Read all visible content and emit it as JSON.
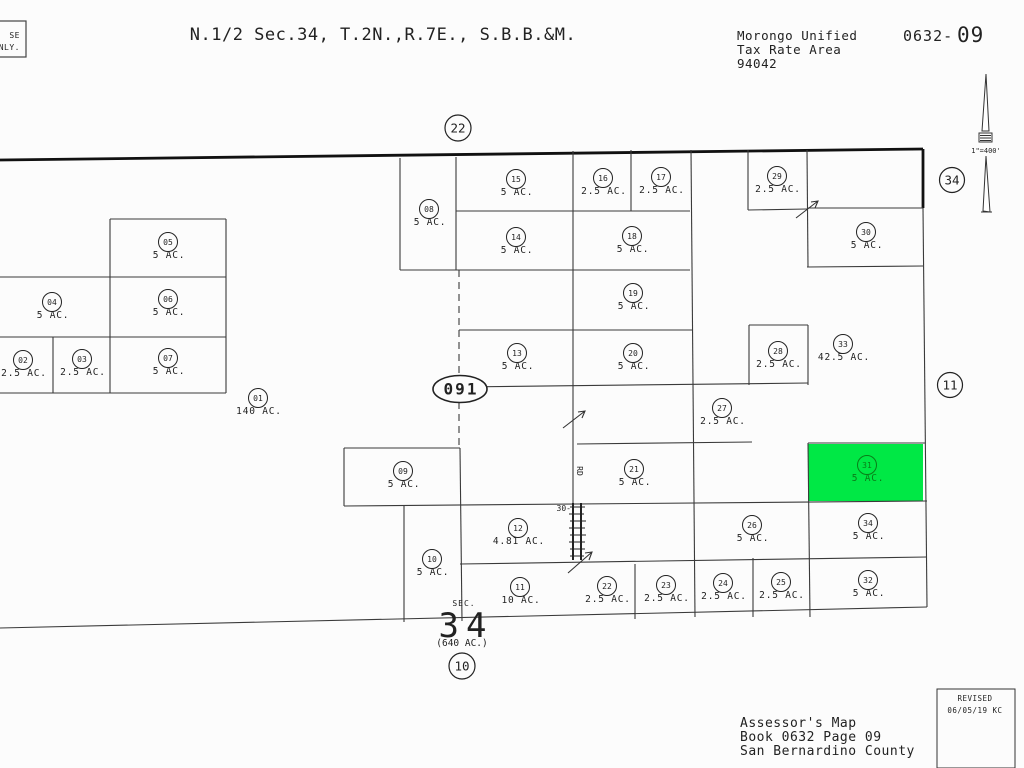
{
  "header": {
    "stamp": {
      "line1": "SE",
      "line2": "NLY."
    },
    "title": "N.1/2 Sec.34, T.2N.,R.7E., S.B.B.&M.",
    "tax_rate_area": {
      "line1": "Morongo Unified",
      "line2": "Tax Rate Area",
      "line3": "94042"
    },
    "book_page": {
      "prefix": "0632-",
      "page": "09"
    }
  },
  "north_arrow": {
    "scale_label": "1\"=400'"
  },
  "map": {
    "adjacent_page_refs": {
      "top": "22",
      "right_upper": "34",
      "right_lower": "11",
      "bottom": "10"
    },
    "book_marker": "091",
    "section": {
      "label": "SEC.",
      "number": "34",
      "acreage": "(640 AC.)"
    },
    "road": {
      "width_label": "30-",
      "name": "RD"
    },
    "highlight_color": "#00e845",
    "highlight_label_color": "#0a7d18",
    "parcels": [
      {
        "n": "01",
        "ac": "140 AC.",
        "x": 258,
        "y": 398
      },
      {
        "n": "02",
        "ac": "2.5 AC.",
        "x": 23,
        "y": 360
      },
      {
        "n": "03",
        "ac": "2.5 AC.",
        "x": 82,
        "y": 359
      },
      {
        "n": "04",
        "ac": "5 AC.",
        "x": 52,
        "y": 302
      },
      {
        "n": "05",
        "ac": "5 AC.",
        "x": 168,
        "y": 242
      },
      {
        "n": "06",
        "ac": "5 AC.",
        "x": 168,
        "y": 299
      },
      {
        "n": "07",
        "ac": "5 AC.",
        "x": 168,
        "y": 358
      },
      {
        "n": "08",
        "ac": "5 AC.",
        "x": 429,
        "y": 209
      },
      {
        "n": "09",
        "ac": "5 AC.",
        "x": 403,
        "y": 471
      },
      {
        "n": "10",
        "ac": "5 AC.",
        "x": 432,
        "y": 559
      },
      {
        "n": "11",
        "ac": "10 AC.",
        "x": 520,
        "y": 587
      },
      {
        "n": "12",
        "ac": "4.81 AC.",
        "x": 518,
        "y": 528
      },
      {
        "n": "13",
        "ac": "5 AC.",
        "x": 517,
        "y": 353
      },
      {
        "n": "14",
        "ac": "5 AC.",
        "x": 516,
        "y": 237
      },
      {
        "n": "15",
        "ac": "5 AC.",
        "x": 516,
        "y": 179
      },
      {
        "n": "16",
        "ac": "2.5 AC.",
        "x": 603,
        "y": 178
      },
      {
        "n": "17",
        "ac": "2.5 AC.",
        "x": 661,
        "y": 177
      },
      {
        "n": "18",
        "ac": "5 AC.",
        "x": 632,
        "y": 236
      },
      {
        "n": "19",
        "ac": "5 AC.",
        "x": 633,
        "y": 293
      },
      {
        "n": "20",
        "ac": "5 AC.",
        "x": 633,
        "y": 353
      },
      {
        "n": "21",
        "ac": "5 AC.",
        "x": 634,
        "y": 469
      },
      {
        "n": "22",
        "ac": "2.5 AC.",
        "x": 607,
        "y": 586
      },
      {
        "n": "23",
        "ac": "2.5 AC.",
        "x": 666,
        "y": 585
      },
      {
        "n": "24",
        "ac": "2.5 AC.",
        "x": 723,
        "y": 583
      },
      {
        "n": "25",
        "ac": "2.5 AC.",
        "x": 781,
        "y": 582
      },
      {
        "n": "26",
        "ac": "5 AC.",
        "x": 752,
        "y": 525
      },
      {
        "n": "27",
        "ac": "2.5 AC.",
        "x": 722,
        "y": 408
      },
      {
        "n": "28",
        "ac": "2.5 AC.",
        "x": 778,
        "y": 351
      },
      {
        "n": "29",
        "ac": "2.5 AC.",
        "x": 777,
        "y": 176
      },
      {
        "n": "30",
        "ac": "5 AC.",
        "x": 866,
        "y": 232
      },
      {
        "n": "31",
        "ac": "5 AC.",
        "x": 867,
        "y": 465,
        "hl": true
      },
      {
        "n": "32",
        "ac": "5 AC.",
        "x": 868,
        "y": 580
      },
      {
        "n": "33",
        "ac": "42.5 AC.",
        "x": 843,
        "y": 344
      },
      {
        "n": "34",
        "ac": "5 AC.",
        "x": 868,
        "y": 523
      }
    ]
  },
  "footer": {
    "line1": "Assessor's Map",
    "line2": "Book 0632 Page 09",
    "line3": "San Bernardino County",
    "revised": {
      "label": "REVISED",
      "date": "06/05/19 KC"
    }
  }
}
